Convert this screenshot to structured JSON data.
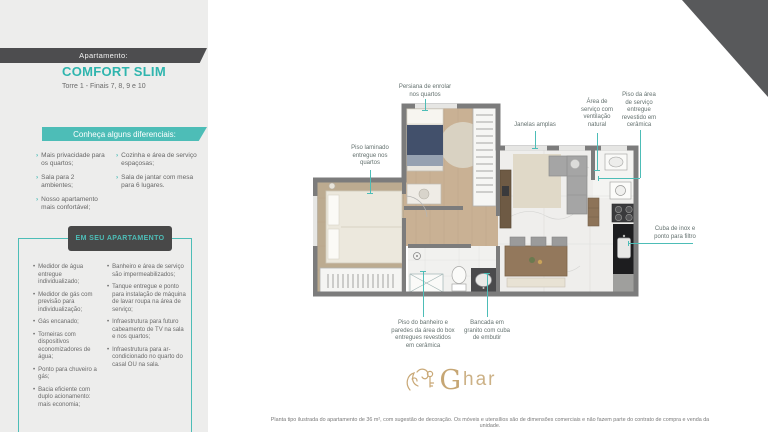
{
  "panel": {
    "apartment_label": "Apartamento:",
    "apartment_name": "COMFORT SLIM",
    "tower_info": "Torre 1 - Finais 7, 8, 9 e 10",
    "differentials": {
      "title": "Conheça alguns diferenciais:",
      "col1": [
        "Mais privacidade para os quartos;",
        "Sala para 2 ambientes;",
        "Nosso apartamento mais confortável;"
      ],
      "col2": [
        "Cozinha e área de serviço espaçosas;",
        "Sala de jantar com mesa para 6 lugares."
      ]
    },
    "in_apartment": {
      "title": "EM SEU APARTAMENTO",
      "col1": [
        "Medidor de água entregue individualizado;",
        "Medidor de gás com previsão para individualização;",
        "Gás encanado;",
        "Torneiras com dispositivos economizadores de água;",
        "Ponto para chuveiro a gás;",
        "Bacia eficiente com duplo acionamento: mais economia;"
      ],
      "col2": [
        "Banheiro e área de serviço são impermeabilizados;",
        "Tanque entregue e ponto para instalação de máquina de lavar roupa na área de serviço;",
        "Infraestrutura para futuro cabeamento de TV na sala e nos quartos;",
        "Infraestrutura para ar-condicionado no quarto do casal OU na sala."
      ]
    }
  },
  "floorplan": {
    "callouts": {
      "persiana": "Persiana de enrolar\nnos quartos",
      "janelas": "Janelas amplas",
      "area_servico": "Área de\nserviço com\nventilação\nnatural",
      "piso_servico": "Piso da área\nde serviço\nentregue\nrevestido em\ncerâmica",
      "piso_laminado": "Piso laminado\nentregue nos\nquartos",
      "cuba_inox": "Cuba de inox e\nponto para filtro",
      "piso_banheiro": "Piso do banheiro e\nparedes da área do box\nentregues revestidos\nem cerâmica",
      "bancada": "Bancada em\ngranito com cuba\nde embutir"
    }
  },
  "logo": {
    "text_g": "G",
    "text_har": "har"
  },
  "disclaimer": "Planta tipo ilustrada do apartamento de 36 m², com sugestão de decoração. Os móveis e utensílios são de dimensões comerciais e não fazem parte do contrato de compra e venda da unidade.",
  "colors": {
    "accent": "#4dbdb7",
    "dark": "#4f4f4f",
    "gold": "#c9ab7c"
  }
}
